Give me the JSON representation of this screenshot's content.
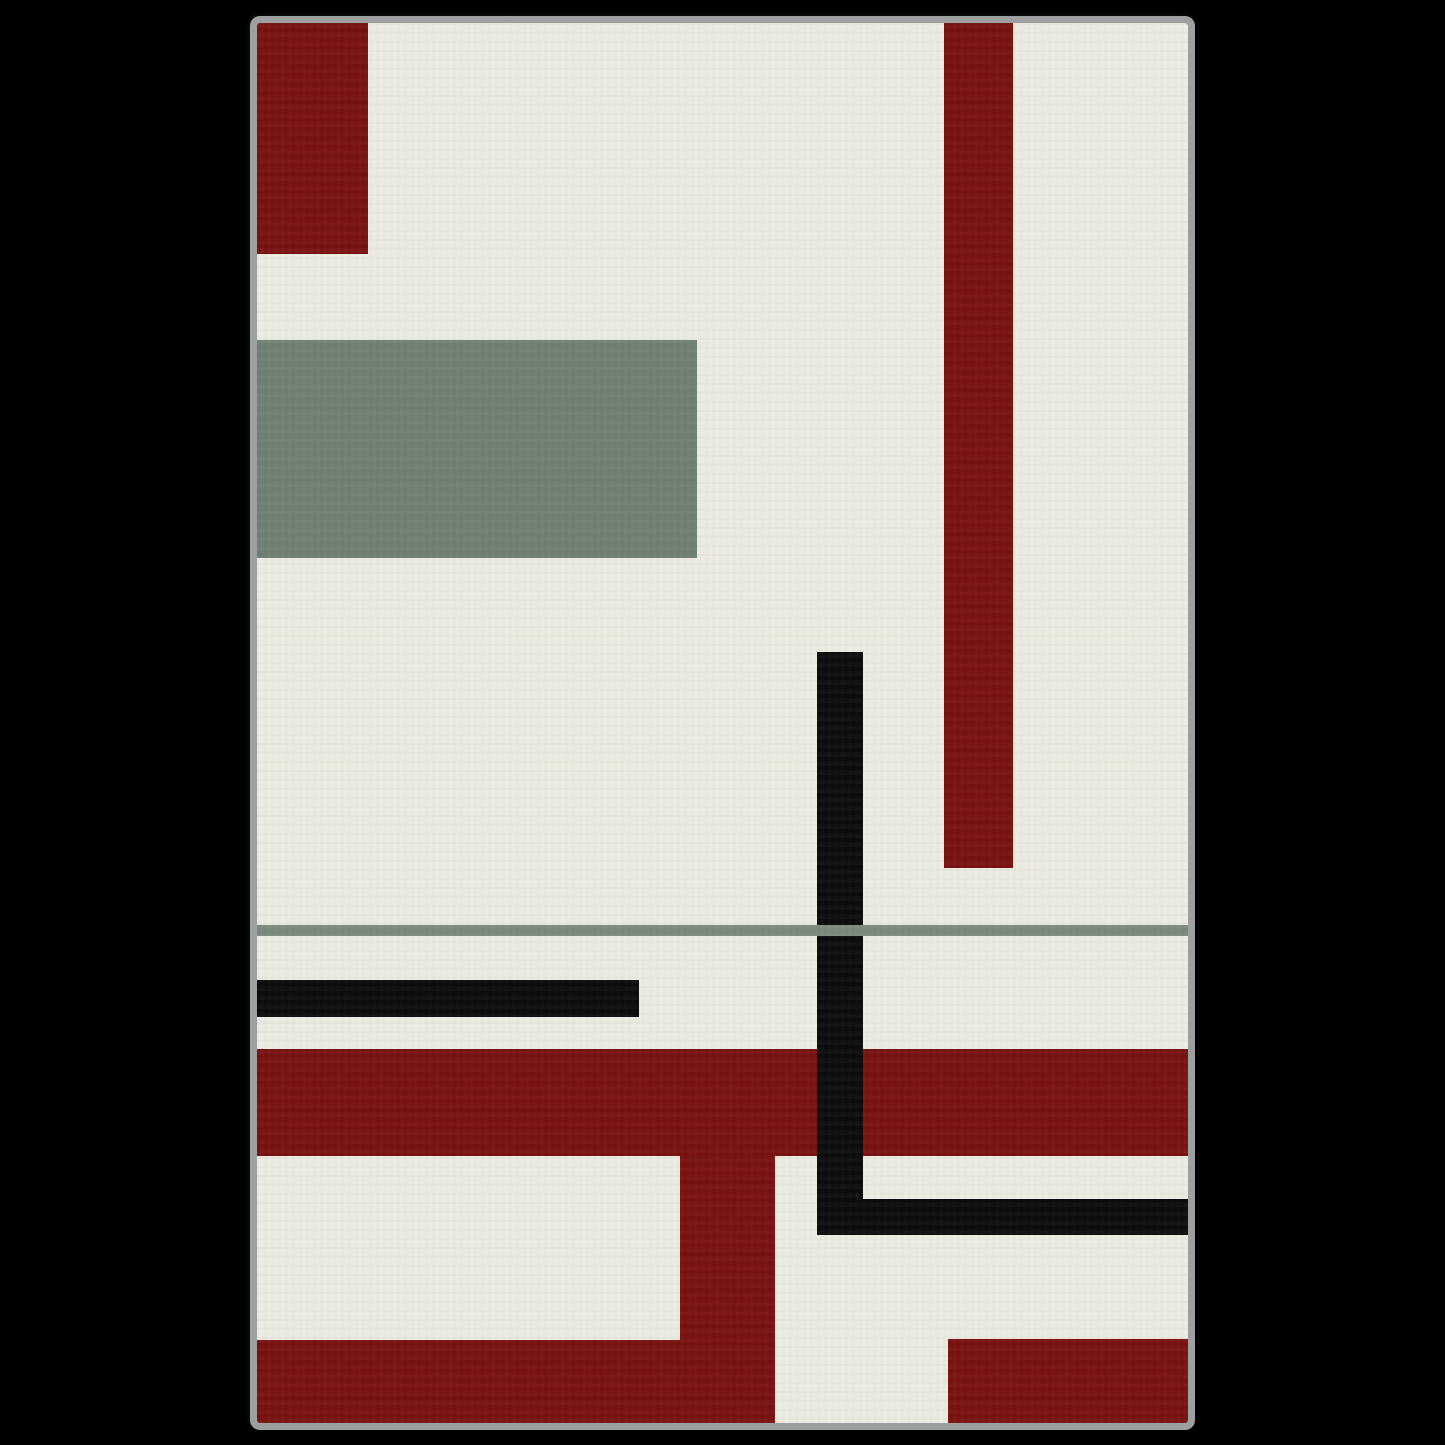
{
  "page": {
    "background_color": "#000000",
    "width": 1445,
    "height": 1445
  },
  "artwork": {
    "description": "abstract-geometric-art-canvas",
    "frame": {
      "x": 250,
      "y": 16,
      "border_width": 7,
      "border_color": "#9da0a0",
      "corner_radius": 10,
      "inner_width": 931,
      "inner_height": 1400,
      "background_color": "#ecebe1"
    },
    "palette": {
      "cream": "#ecebe1",
      "dark_red": "#771110",
      "sage_green": "#6e8071",
      "line_green": "#7b897b",
      "black": "#0b0b0b",
      "frame_gray": "#9da0a0"
    },
    "shapes": [
      {
        "name": "top-left-red-rect",
        "x": 0,
        "y": 0,
        "w": 111,
        "h": 231,
        "color": "#771110",
        "z": 1
      },
      {
        "name": "right-red-bar",
        "x": 687,
        "y": 0,
        "w": 69,
        "h": 845,
        "color": "#771110",
        "z": 1
      },
      {
        "name": "sage-green-rect",
        "x": 0,
        "y": 317,
        "w": 440,
        "h": 218,
        "color": "#6e8071",
        "z": 1
      },
      {
        "name": "black-vertical-bar",
        "x": 560,
        "y": 629,
        "w": 46,
        "h": 583,
        "color": "#0b0b0b",
        "z": 3
      },
      {
        "name": "green-horizontal-line",
        "x": 0,
        "y": 902,
        "w": 931,
        "h": 11,
        "color": "#7b897b",
        "z": 4
      },
      {
        "name": "black-horizontal-bar-left",
        "x": 0,
        "y": 957,
        "w": 382,
        "h": 37,
        "color": "#0b0b0b",
        "z": 2
      },
      {
        "name": "red-horizontal-band",
        "x": 0,
        "y": 1026,
        "w": 931,
        "h": 107,
        "color": "#771110",
        "z": 1
      },
      {
        "name": "red-vertical-column",
        "x": 423,
        "y": 1133,
        "w": 95,
        "h": 267,
        "color": "#771110",
        "z": 1
      },
      {
        "name": "black-horizontal-arm",
        "x": 560,
        "y": 1176,
        "w": 371,
        "h": 36,
        "color": "#0b0b0b",
        "z": 3
      },
      {
        "name": "bottom-left-red-rect",
        "x": 0,
        "y": 1317,
        "w": 423,
        "h": 83,
        "color": "#771110",
        "z": 1
      },
      {
        "name": "bottom-right-red-rect",
        "x": 691,
        "y": 1316,
        "w": 240,
        "h": 84,
        "color": "#771110",
        "z": 1
      }
    ]
  }
}
